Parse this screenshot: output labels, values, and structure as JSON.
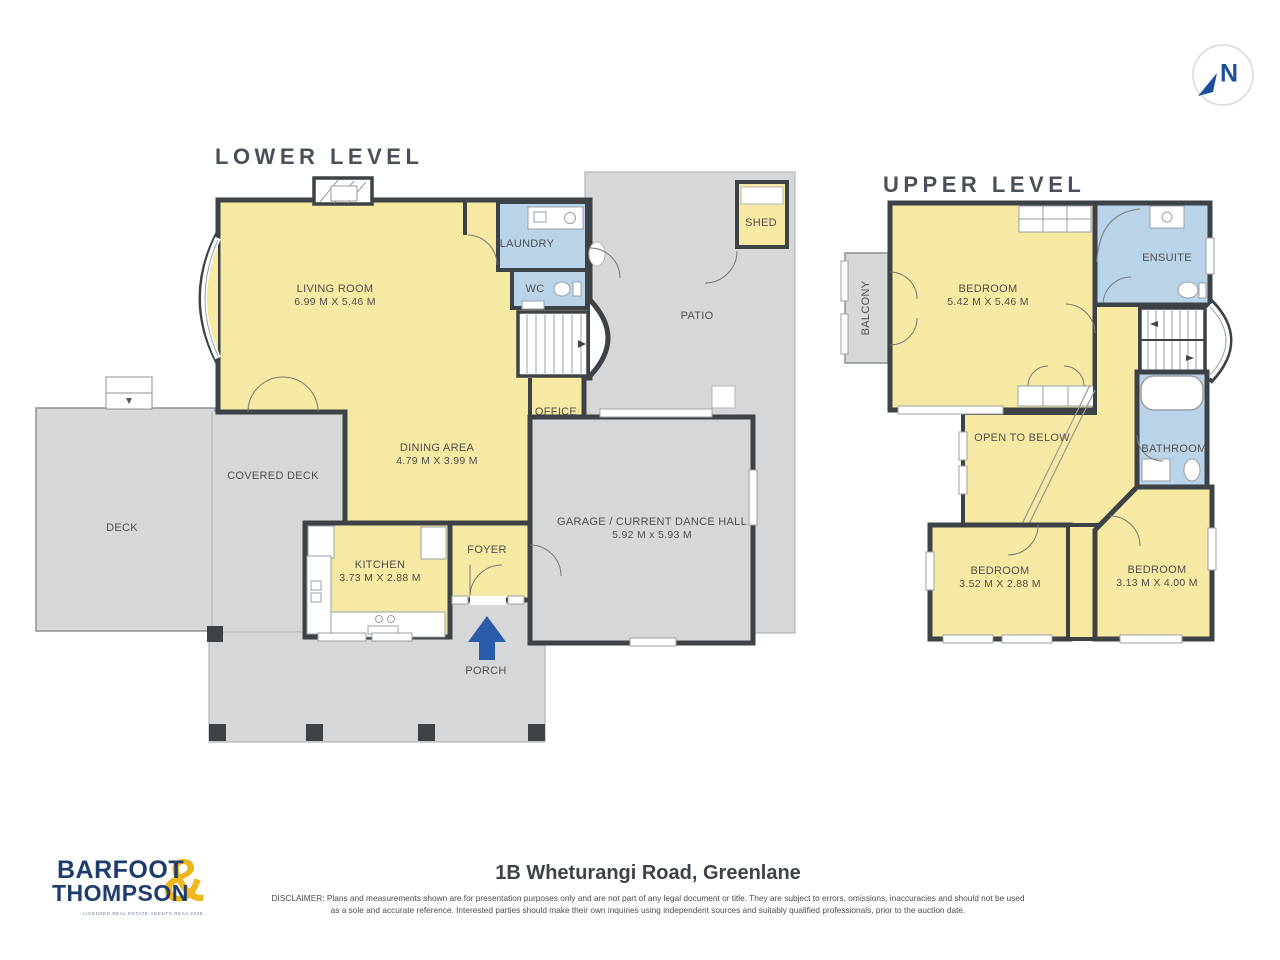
{
  "compass": {
    "letter": "N"
  },
  "lower": {
    "title": "LOWER LEVEL",
    "rooms": {
      "living": {
        "name": "LIVING ROOM",
        "dims": "6.99 M X 5.46 M"
      },
      "laundry": {
        "name": "LAUNDRY"
      },
      "wc": {
        "name": "WC"
      },
      "office": {
        "name": "OFFICE"
      },
      "patio": {
        "name": "PATIO"
      },
      "shed": {
        "name": "SHED"
      },
      "dining": {
        "name": "DINING AREA",
        "dims": "4.79 M X 3.99 M"
      },
      "kitchen": {
        "name": "KITCHEN",
        "dims": "3.73 M X 2.88 M"
      },
      "foyer": {
        "name": "FOYER"
      },
      "garage": {
        "name": "GARAGE / CURRENT DANCE HALL",
        "dims": "5.92 M x 5.93 M"
      },
      "covered_deck": {
        "name": "COVERED DECK"
      },
      "deck": {
        "name": "DECK"
      },
      "porch": {
        "name": "PORCH"
      }
    }
  },
  "upper": {
    "title": "UPPER LEVEL",
    "rooms": {
      "balcony": {
        "name": "BALCONY"
      },
      "bedroom_main": {
        "name": "BEDROOM",
        "dims": "5.42 M X 5.46 M"
      },
      "ensuite": {
        "name": "ENSUITE"
      },
      "open_to_below": {
        "name": "OPEN TO BELOW"
      },
      "bathroom": {
        "name": "BATHROOM"
      },
      "bedroom_two": {
        "name": "BEDROOM",
        "dims": "3.52 M X 2.88 M"
      },
      "bedroom_three": {
        "name": "BEDROOM",
        "dims": "3.13 M X 4.00 M"
      }
    }
  },
  "footer": {
    "brand_line1": "BARFOOT",
    "brand_amp": "&",
    "brand_line2": "THOMPSON",
    "brand_tagline": "LICENSED REAL ESTATE AGENTS REAA 2008",
    "address": "1B Wheturangi Road, Greenlane",
    "disclaimer_line1": "DISCLAIMER: Plans and measurements shown are for presentation purposes only and are not part of any legal document or title. They are subject to errors, omissions, inaccuracies and should not be used",
    "disclaimer_line2": "as a sole and accurate reference. Interested parties should make their own inquiries using independent sources and suitably qualified professionals, prior to the auction date."
  },
  "colors": {
    "room_yellow": "#f6e9a3",
    "wet_area_blue": "#b9d3e8",
    "outdoor_grey": "#d5d7d8",
    "wall_dark": "#3d4247",
    "brand_navy": "#1e3c6d",
    "brand_gold": "#f0b71c",
    "north_blue": "#1d4e9e",
    "porch_arrow_blue": "#2b5ca9"
  }
}
